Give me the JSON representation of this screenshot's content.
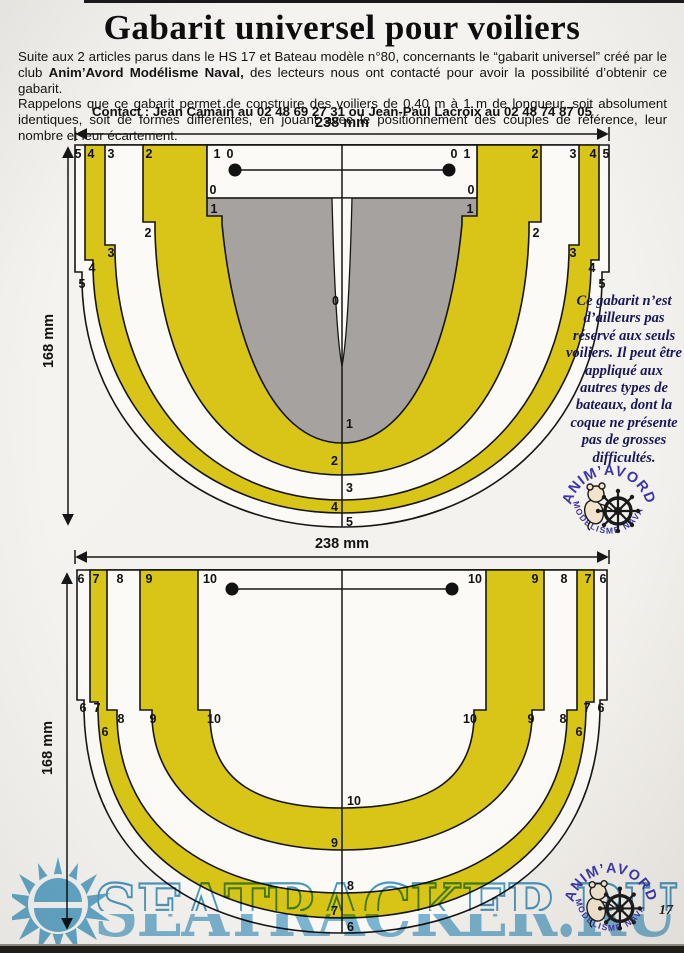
{
  "page": {
    "title": "Gabarit universel pour voiliers",
    "intro": {
      "p1_part1": "Suite aux 2 articles parus dans le HS 17 et Bateau modèle n°80, concernants le “gabarit universel” créé par le club",
      "p1_bold": "Anim’Avord Modélisme Naval,",
      "p1_part2": "des lecteurs nous ont contacté pour avoir la possibilité d’obtenir ce gabarit.",
      "p2": "Rappelons que ce gabarit permet de construire des voiliers de 0,40 m à 1 m de longueur, soit absolument identiques, soit de formes différentes, en jouant avec le positionnement des couples de référence, leur nombre et leur écartement."
    },
    "contact": "Contact : Jean Camain au 02 48 69 27 31 ou Jean-Paul Lacroix au 02 48 74 87 05",
    "side_note": "Ce gabarit n’est d’ailleurs pas réservé aux seuls voiliers. Il peut être appliqué aux autres types de bateaux, dont la coque ne présente pas de grosses difficultés.",
    "page_number": "17"
  },
  "logo": {
    "arc_top": "ANIM’AVORD",
    "arc_bottom": "MODELISME NAVAL"
  },
  "watermark": {
    "text": "SEATRACKER.RU"
  },
  "diagram_top": {
    "width_label": "238 mm",
    "height_label": "168 mm",
    "top_row_left": [
      "5",
      "4",
      "3",
      "2"
    ],
    "box_corner_left": [
      "1",
      "0"
    ],
    "box_corner_right": [
      "0",
      "1"
    ],
    "top_row_right": [
      "2",
      "3",
      "4",
      "5"
    ],
    "box_bottom_left": "0",
    "box_bottom_right": "0",
    "gray_left": "1",
    "gray_right": "1",
    "step_labels": [
      "2",
      "3",
      "4",
      "5"
    ],
    "centerline_labels": [
      "0",
      "1",
      "2",
      "3",
      "4",
      "5"
    ]
  },
  "diagram_bottom": {
    "width_label": "238 mm",
    "height_label": "168 mm",
    "top_row_left": [
      "6",
      "7",
      "8",
      "9",
      "10"
    ],
    "top_row_right": [
      "10",
      "9",
      "8",
      "7",
      "6"
    ],
    "step_labels_left": [
      "6",
      "7",
      "8",
      "9",
      "10"
    ],
    "step_labels_right": [
      "10",
      "9",
      "8",
      "7",
      "6"
    ],
    "outer_band_label": "6",
    "centerline_labels": [
      "10",
      "9",
      "8",
      "7",
      "6"
    ]
  },
  "colors": {
    "template_yellow": "#d8c517",
    "template_gray": "#a6a29f",
    "note_navy": "#17175a",
    "logo_blue": "#3c36aa",
    "watermark_blue": "#7db9da"
  }
}
